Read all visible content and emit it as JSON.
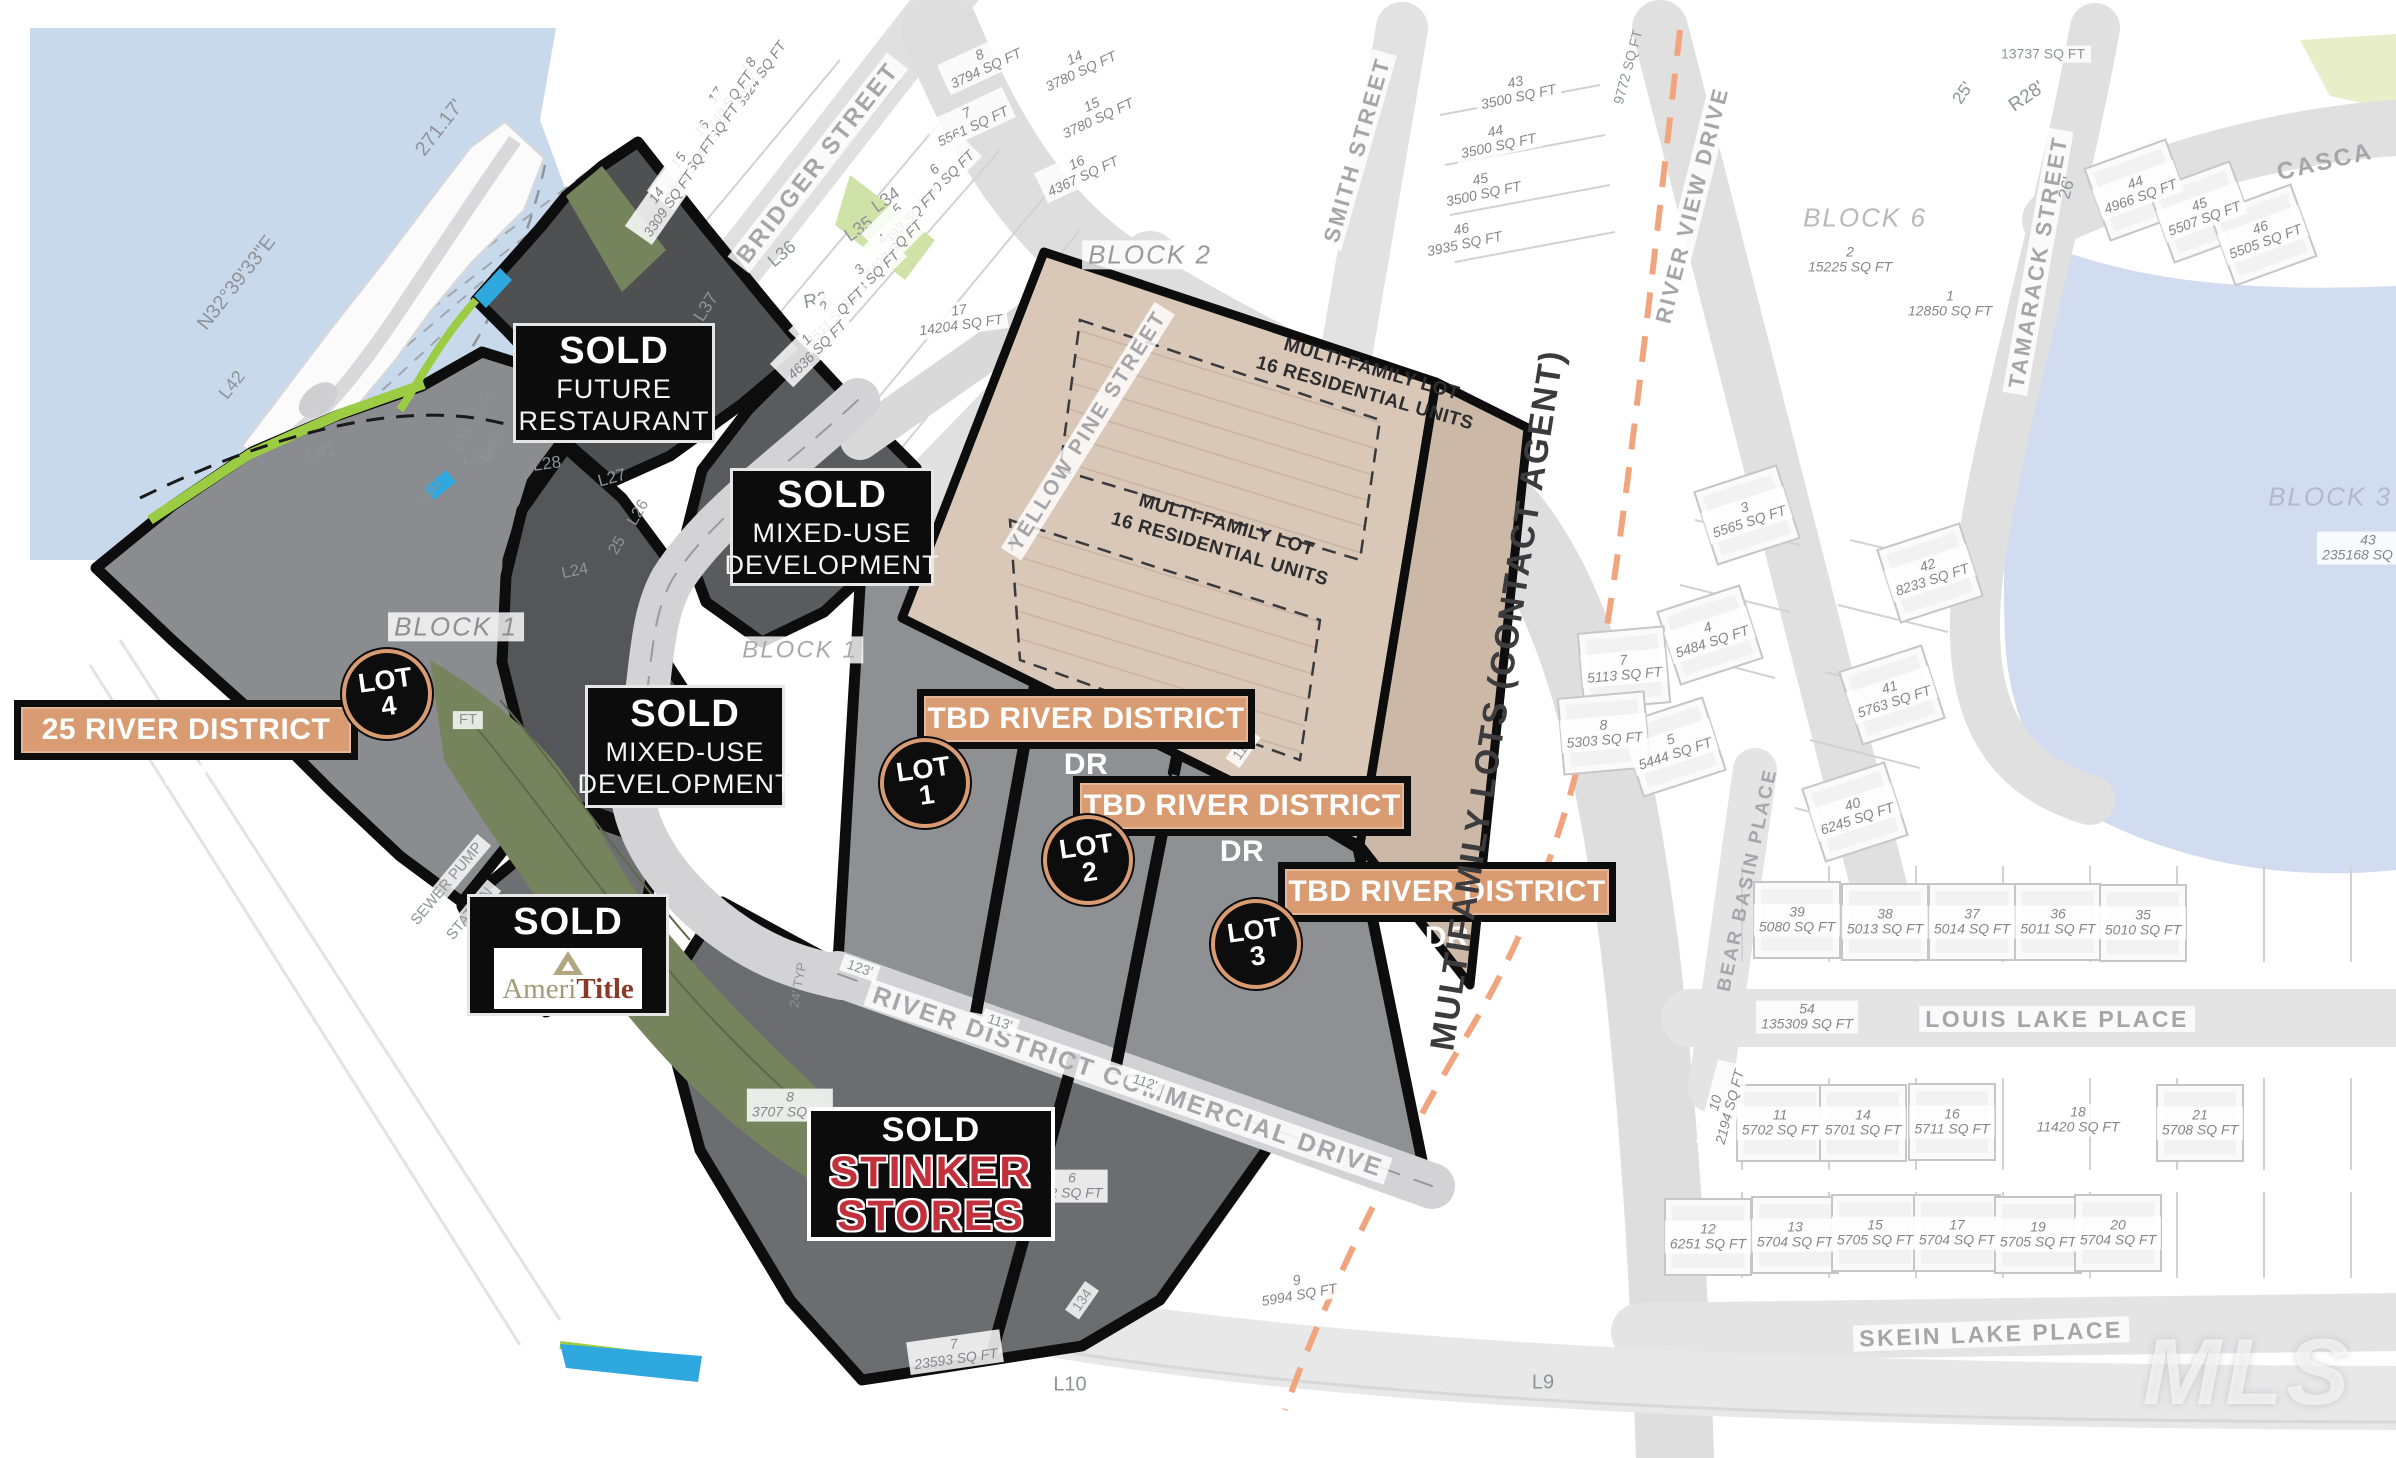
{
  "colors": {
    "water": "#c9d9ec",
    "pond": "#d2dcf0",
    "tan_tag": "#d89b72",
    "black": "#0d0d0e",
    "dark_parcel": "#4f5052",
    "mid_parcel": "#8a8c8f",
    "olive": "#76845e",
    "lime": "#9bcc44",
    "bright_blue": "#2fa8e0",
    "mf_tan": "#d9c8b8",
    "mf_strip": "#cbb8a7",
    "stinker_red": "#c2303c",
    "ameri_tan": "#a39a77",
    "ameri_rust": "#8a3a26",
    "orange_dash": "#f1a57e"
  },
  "overlays": {
    "sold_boxes": [
      {
        "id": "restaurant",
        "tag": "SOLD",
        "lines": [
          "FUTURE",
          "RESTAURANT"
        ],
        "x": 513,
        "y": 323,
        "w": 196,
        "h": 114
      },
      {
        "id": "mixed-use-1",
        "tag": "SOLD",
        "lines": [
          "MIXED-USE",
          "DEVELOPMENT"
        ],
        "x": 730,
        "y": 468,
        "w": 198,
        "h": 112
      },
      {
        "id": "mixed-use-2",
        "tag": "SOLD",
        "lines": [
          "MIXED-USE",
          "DEVELOPMENT"
        ],
        "x": 585,
        "y": 685,
        "w": 194,
        "h": 117
      }
    ],
    "ameritile_box": {
      "tag": "SOLD",
      "brand_prefix": "Ameri",
      "brand_suffix": "Title",
      "x": 467,
      "y": 894,
      "w": 196,
      "h": 116
    },
    "stinker_box": {
      "tag": "SOLD",
      "brand_lines": [
        "STINKER",
        "STORES"
      ],
      "x": 807,
      "y": 1107,
      "w": 240,
      "h": 126
    },
    "address_tags": [
      {
        "text": "25 RIVER DISTRICT DR",
        "x": 14,
        "y": 700,
        "w": 330
      },
      {
        "text": "TBD RIVER DISTRICT DR",
        "x": 917,
        "y": 689,
        "w": 324
      },
      {
        "text": "TBD RIVER DISTRICT DR",
        "x": 1073,
        "y": 776,
        "w": 324
      },
      {
        "text": "TBD RIVER DISTRICT DR",
        "x": 1278,
        "y": 862,
        "w": 324
      }
    ],
    "lot_markers": [
      {
        "label": "LOT",
        "num": "4",
        "cx": 387,
        "cy": 694
      },
      {
        "label": "LOT",
        "num": "1",
        "cx": 925,
        "cy": 783
      },
      {
        "label": "LOT",
        "num": "2",
        "cx": 1088,
        "cy": 860
      },
      {
        "label": "LOT",
        "num": "3",
        "cx": 1256,
        "cy": 944
      }
    ],
    "watermark": {
      "text": "MLS",
      "x": 2248,
      "y": 1372
    }
  },
  "multifamily": {
    "area_labels": [
      {
        "lines": [
          "MULTI-FAMILY LOT",
          "16 RESIDENTIAL UNITS"
        ],
        "x": 1368,
        "y": 382,
        "rot": 16
      },
      {
        "lines": [
          "MULTI-FAMILY LOT",
          "16 RESIDENTIAL UNITS"
        ],
        "x": 1223,
        "y": 538,
        "rot": 16
      }
    ],
    "strip_label": {
      "text": "MULTIFAMILY LOTS (CONTACT AGENT)",
      "x": 1498,
      "y": 700,
      "rot": -81
    }
  },
  "labels": {
    "streets": [
      {
        "text": "BRIDGER STREET",
        "x": 818,
        "y": 163,
        "rot": -52,
        "size": 24,
        "chip": true
      },
      {
        "text": "YELLOW PINE STREET",
        "x": 1088,
        "y": 431,
        "rot": -58,
        "size": 21,
        "chip": true
      },
      {
        "text": "SMITH STREET",
        "x": 1357,
        "y": 150,
        "rot": -74,
        "size": 22,
        "chip": true
      },
      {
        "text": "RIVER VIEW DRIVE",
        "x": 1692,
        "y": 205,
        "rot": -76,
        "size": 22,
        "chip": true
      },
      {
        "text": "TAMARACK STREET",
        "x": 2038,
        "y": 262,
        "rot": -80,
        "size": 22,
        "chip": true
      },
      {
        "text": "CASCA",
        "x": 2325,
        "y": 162,
        "rot": -13,
        "size": 24,
        "chip": false
      },
      {
        "text": "LOUIS LAKE PLACE",
        "x": 2057,
        "y": 1019,
        "rot": 0,
        "size": 23,
        "chip": true
      },
      {
        "text": "SKEIN LAKE PLACE",
        "x": 1991,
        "y": 1334,
        "rot": -2,
        "size": 23,
        "chip": true
      },
      {
        "text": "BEAR BASIN PLACE",
        "x": 1748,
        "y": 880,
        "rot": -78,
        "size": 19,
        "chip": false
      },
      {
        "text": "RIVER DISTRICT COMMERCIAL DRIVE",
        "x": 1128,
        "y": 1082,
        "rot": 19,
        "size": 25,
        "chip": true
      }
    ],
    "blocks": [
      {
        "text": "BLOCK 1",
        "x": 456,
        "y": 627,
        "rot": 0,
        "size": 26,
        "color": "#8f8f92",
        "chip": true
      },
      {
        "text": "BLOCK 1",
        "x": 800,
        "y": 650,
        "rot": 0,
        "size": 24,
        "color": "#aaaaad",
        "chip": true
      },
      {
        "text": "BLOCK 2",
        "x": 1150,
        "y": 255,
        "rot": 0,
        "size": 26,
        "color": "#9a9a9d",
        "chip": true
      },
      {
        "text": "BLOCK 6",
        "x": 1865,
        "y": 218,
        "rot": 0,
        "size": 26,
        "color": "#b9b9bc",
        "chip": false
      },
      {
        "text": "BLOCK 3",
        "x": 2330,
        "y": 497,
        "rot": 0,
        "size": 26,
        "color": "#b3b8cc",
        "chip": false
      }
    ],
    "survey": [
      {
        "text": "N32°39'33\"E",
        "x": 237,
        "y": 283,
        "rot": -52,
        "size": 20
      },
      {
        "text": "271.17'",
        "x": 440,
        "y": 128,
        "rot": -52,
        "size": 20
      },
      {
        "text": "L42",
        "x": 232,
        "y": 385,
        "rot": -52,
        "size": 18
      },
      {
        "text": "L41",
        "x": 321,
        "y": 452,
        "rot": -10,
        "size": 18
      },
      {
        "text": "L40",
        "x": 492,
        "y": 448,
        "rot": -60,
        "size": 18
      },
      {
        "text": "L39",
        "x": 543,
        "y": 428,
        "rot": -55,
        "size": 18
      },
      {
        "text": "L38",
        "x": 642,
        "y": 367,
        "rot": -60,
        "size": 18
      },
      {
        "text": "L37",
        "x": 706,
        "y": 307,
        "rot": -58,
        "size": 18
      },
      {
        "text": "L36",
        "x": 782,
        "y": 254,
        "rot": -40,
        "size": 18
      },
      {
        "text": "L35",
        "x": 859,
        "y": 229,
        "rot": -35,
        "size": 18
      },
      {
        "text": "L34",
        "x": 886,
        "y": 200,
        "rot": -35,
        "size": 18
      },
      {
        "text": "L32",
        "x": 482,
        "y": 403,
        "rot": -55,
        "size": 15
      },
      {
        "text": "L31",
        "x": 462,
        "y": 438,
        "rot": -75,
        "size": 15
      },
      {
        "text": "L30",
        "x": 430,
        "y": 492,
        "rot": -55,
        "size": 15
      },
      {
        "text": "L29",
        "x": 477,
        "y": 458,
        "rot": -8,
        "size": 17
      },
      {
        "text": "L28",
        "x": 547,
        "y": 464,
        "rot": -8,
        "size": 17
      },
      {
        "text": "L27",
        "x": 612,
        "y": 478,
        "rot": -15,
        "size": 17
      },
      {
        "text": "L26",
        "x": 639,
        "y": 513,
        "rot": -60,
        "size": 16
      },
      {
        "text": "25",
        "x": 618,
        "y": 546,
        "rot": -60,
        "size": 16
      },
      {
        "text": "L24",
        "x": 575,
        "y": 572,
        "rot": -12,
        "size": 16
      },
      {
        "text": "L10",
        "x": 1070,
        "y": 1385,
        "rot": 0,
        "size": 20
      },
      {
        "text": "L9",
        "x": 1543,
        "y": 1383,
        "rot": 0,
        "size": 20
      },
      {
        "text": "R28'",
        "x": 823,
        "y": 300,
        "rot": -10,
        "size": 19
      },
      {
        "text": "R28'",
        "x": 2027,
        "y": 97,
        "rot": -35,
        "size": 19
      },
      {
        "text": "25'",
        "x": 1963,
        "y": 93,
        "rot": -55,
        "size": 17
      },
      {
        "text": "26'",
        "x": 2067,
        "y": 188,
        "rot": -75,
        "size": 17
      },
      {
        "text": "123'",
        "x": 860,
        "y": 968,
        "rot": 19,
        "size": 14,
        "chip": true
      },
      {
        "text": "113'",
        "x": 1000,
        "y": 1022,
        "rot": 19,
        "size": 14,
        "chip": true
      },
      {
        "text": "112'",
        "x": 1145,
        "y": 1082,
        "rot": 19,
        "size": 14,
        "chip": true
      },
      {
        "text": "112'",
        "x": 1243,
        "y": 748,
        "rot": -55,
        "size": 14,
        "chip": true
      },
      {
        "text": "229'",
        "x": 983,
        "y": 827,
        "rot": -72,
        "size": 14
      },
      {
        "text": "229'",
        "x": 1122,
        "y": 887,
        "rot": -72,
        "size": 14
      },
      {
        "text": "229'",
        "x": 1352,
        "y": 1020,
        "rot": -72,
        "size": 14
      },
      {
        "text": "134",
        "x": 1082,
        "y": 1300,
        "rot": -55,
        "size": 14,
        "chip": true
      },
      {
        "text": "24' TYP",
        "x": 798,
        "y": 985,
        "rot": -80,
        "size": 13
      },
      {
        "text": "FT",
        "x": 468,
        "y": 720,
        "rot": 0,
        "size": 15,
        "chip": true
      },
      {
        "text": "9772 SQ FT",
        "x": 1628,
        "y": 67,
        "rot": -75,
        "size": 14
      },
      {
        "text": "13737 SQ FT",
        "x": 2043,
        "y": 54,
        "rot": 0,
        "size": 14,
        "chip": true
      },
      {
        "text": "COMMERCIAL LOTS",
        "x": 1105,
        "y": 762,
        "rot": 17,
        "size": 19
      },
      {
        "text": "SEWER PUMP",
        "x": 447,
        "y": 884,
        "rot": -50,
        "size": 15,
        "chip": true
      },
      {
        "text": "STATION",
        "x": 470,
        "y": 914,
        "rot": -50,
        "size": 15,
        "chip": true
      }
    ],
    "lots": [
      {
        "n": "18",
        "sq": "3924 SQ FT",
        "x": 755,
        "y": 70,
        "rot": -55,
        "house": false
      },
      {
        "n": "17",
        "sq": "3740 SQ FT",
        "x": 722,
        "y": 100,
        "rot": -55,
        "house": false
      },
      {
        "n": "16",
        "sq": "3555 SQ FT",
        "x": 708,
        "y": 133,
        "rot": -55,
        "house": false
      },
      {
        "n": "15",
        "sq": "3371 SQ FT",
        "x": 685,
        "y": 165,
        "rot": -55,
        "house": false
      },
      {
        "n": "14",
        "sq": "3309 SQ FT",
        "x": 663,
        "y": 200,
        "rot": -55,
        "house": false
      },
      {
        "n": "8",
        "sq": "3794 SQ FT",
        "x": 983,
        "y": 62,
        "rot": -25,
        "house": false
      },
      {
        "n": "7",
        "sq": "5561 SQ FT",
        "x": 970,
        "y": 120,
        "rot": -25,
        "house": false
      },
      {
        "n": "6",
        "sq": "4960 SQ FT",
        "x": 940,
        "y": 175,
        "rot": -45,
        "house": false
      },
      {
        "n": "5",
        "sq": "3493 SQ FT",
        "x": 903,
        "y": 215,
        "rot": -45,
        "house": false
      },
      {
        "n": "4",
        "sq": "3498 SQ FT",
        "x": 888,
        "y": 245,
        "rot": -45,
        "house": false
      },
      {
        "n": "3",
        "sq": "3503 SQ FT",
        "x": 865,
        "y": 275,
        "rot": -45,
        "house": false
      },
      {
        "n": "2",
        "sq": "3511 SQ FT",
        "x": 830,
        "y": 312,
        "rot": -45,
        "house": false
      },
      {
        "n": "1",
        "sq": "4636 SQ FT",
        "x": 812,
        "y": 345,
        "rot": -45,
        "house": false
      },
      {
        "n": "17",
        "sq": "14204 SQ FT",
        "x": 960,
        "y": 318,
        "rot": -8,
        "house": false
      },
      {
        "n": "14",
        "sq": "3780 SQ FT",
        "x": 1078,
        "y": 65,
        "rot": -25,
        "house": false
      },
      {
        "n": "15",
        "sq": "3780 SQ FT",
        "x": 1095,
        "y": 112,
        "rot": -25,
        "house": false
      },
      {
        "n": "16",
        "sq": "4367 SQ FT",
        "x": 1080,
        "y": 170,
        "rot": -25,
        "house": false
      },
      {
        "n": "43",
        "sq": "3500 SQ FT",
        "x": 1517,
        "y": 90,
        "rot": -12,
        "house": false
      },
      {
        "n": "44",
        "sq": "3500 SQ FT",
        "x": 1497,
        "y": 139,
        "rot": -12,
        "house": false
      },
      {
        "n": "45",
        "sq": "3500 SQ FT",
        "x": 1482,
        "y": 187,
        "rot": -12,
        "house": false
      },
      {
        "n": "46",
        "sq": "3935 SQ FT",
        "x": 1463,
        "y": 237,
        "rot": -12,
        "house": false
      },
      {
        "n": "44",
        "sq": "4966 SQ FT",
        "x": 2138,
        "y": 190,
        "rot": -20,
        "house": true
      },
      {
        "n": "45",
        "sq": "5507 SQ FT",
        "x": 2202,
        "y": 212,
        "rot": -20,
        "house": true
      },
      {
        "n": "46",
        "sq": "5505 SQ FT",
        "x": 2263,
        "y": 235,
        "rot": -20,
        "house": true
      },
      {
        "n": "2",
        "sq": "15225 SQ FT",
        "x": 1850,
        "y": 260,
        "rot": 0,
        "house": false
      },
      {
        "n": "1",
        "sq": "12850 SQ FT",
        "x": 1950,
        "y": 304,
        "rot": 0,
        "house": false
      },
      {
        "n": "43",
        "sq": "235168 SQ FT",
        "x": 2368,
        "y": 548,
        "rot": 0,
        "house": false
      },
      {
        "n": "3",
        "sq": "5565 SQ FT",
        "x": 1747,
        "y": 515,
        "rot": -18,
        "house": true
      },
      {
        "n": "4",
        "sq": "5484 SQ FT",
        "x": 1710,
        "y": 635,
        "rot": -18,
        "house": true
      },
      {
        "n": "5",
        "sq": "5444 SQ FT",
        "x": 1673,
        "y": 747,
        "rot": -18,
        "house": true
      },
      {
        "n": "42",
        "sq": "8233 SQ FT",
        "x": 1930,
        "y": 573,
        "rot": -18,
        "house": true
      },
      {
        "n": "41",
        "sq": "5763 SQ FT",
        "x": 1892,
        "y": 695,
        "rot": -18,
        "house": true
      },
      {
        "n": "40",
        "sq": "6245 SQ FT",
        "x": 1855,
        "y": 812,
        "rot": -18,
        "house": true
      },
      {
        "n": "7",
        "sq": "5113 SQ FT",
        "x": 1624,
        "y": 668,
        "rot": -5,
        "house": true
      },
      {
        "n": "8",
        "sq": "5303 SQ FT",
        "x": 1604,
        "y": 733,
        "rot": -5,
        "house": true
      },
      {
        "n": "10",
        "sq": "2194 SQ FT",
        "x": 1723,
        "y": 1105,
        "rot": -75,
        "house": false
      },
      {
        "n": "39",
        "sq": "5080 SQ FT",
        "x": 1797,
        "y": 920,
        "rot": 0,
        "house": true
      },
      {
        "n": "38",
        "sq": "5013 SQ FT",
        "x": 1885,
        "y": 922,
        "rot": 0,
        "house": true
      },
      {
        "n": "37",
        "sq": "5014 SQ FT",
        "x": 1972,
        "y": 922,
        "rot": 0,
        "house": true
      },
      {
        "n": "36",
        "sq": "5011 SQ FT",
        "x": 2058,
        "y": 922,
        "rot": 0,
        "house": true
      },
      {
        "n": "35",
        "sq": "5010 SQ FT",
        "x": 2143,
        "y": 923,
        "rot": 0,
        "house": true
      },
      {
        "n": "54",
        "sq": "135309 SQ FT",
        "x": 1807,
        "y": 1017,
        "rot": 0,
        "house": false
      },
      {
        "n": "11",
        "sq": "5702 SQ FT",
        "x": 1780,
        "y": 1123,
        "rot": 0,
        "house": true
      },
      {
        "n": "14",
        "sq": "5701 SQ FT",
        "x": 1863,
        "y": 1123,
        "rot": 0,
        "house": true
      },
      {
        "n": "16",
        "sq": "5711 SQ FT",
        "x": 1952,
        "y": 1122,
        "rot": 0,
        "house": true
      },
      {
        "n": "18",
        "sq": "11420 SQ FT",
        "x": 2078,
        "y": 1120,
        "rot": 0,
        "house": false
      },
      {
        "n": "21",
        "sq": "5708 SQ FT",
        "x": 2200,
        "y": 1123,
        "rot": 0,
        "house": true
      },
      {
        "n": "12",
        "sq": "6251 SQ FT",
        "x": 1708,
        "y": 1237,
        "rot": 0,
        "house": true
      },
      {
        "n": "13",
        "sq": "5704 SQ FT",
        "x": 1795,
        "y": 1235,
        "rot": 0,
        "house": true
      },
      {
        "n": "15",
        "sq": "5705 SQ FT",
        "x": 1875,
        "y": 1233,
        "rot": 0,
        "house": true
      },
      {
        "n": "17",
        "sq": "5704 SQ FT",
        "x": 1957,
        "y": 1233,
        "rot": 0,
        "house": true
      },
      {
        "n": "19",
        "sq": "5705 SQ FT",
        "x": 2038,
        "y": 1235,
        "rot": 0,
        "house": true
      },
      {
        "n": "20",
        "sq": "5704 SQ FT",
        "x": 2118,
        "y": 1233,
        "rot": 0,
        "house": true
      },
      {
        "n": "8",
        "sq": "3707 SQ FT",
        "x": 790,
        "y": 1105,
        "rot": 0,
        "house": false
      },
      {
        "n": "6",
        "sq": "02 SQ FT",
        "x": 1072,
        "y": 1186,
        "rot": 0,
        "house": false
      },
      {
        "n": "7",
        "sq": "23593 SQ FT",
        "x": 955,
        "y": 1352,
        "rot": -8,
        "house": false
      },
      {
        "n": "9",
        "sq": "5994 SQ FT",
        "x": 1298,
        "y": 1288,
        "rot": -10,
        "house": false
      }
    ]
  }
}
